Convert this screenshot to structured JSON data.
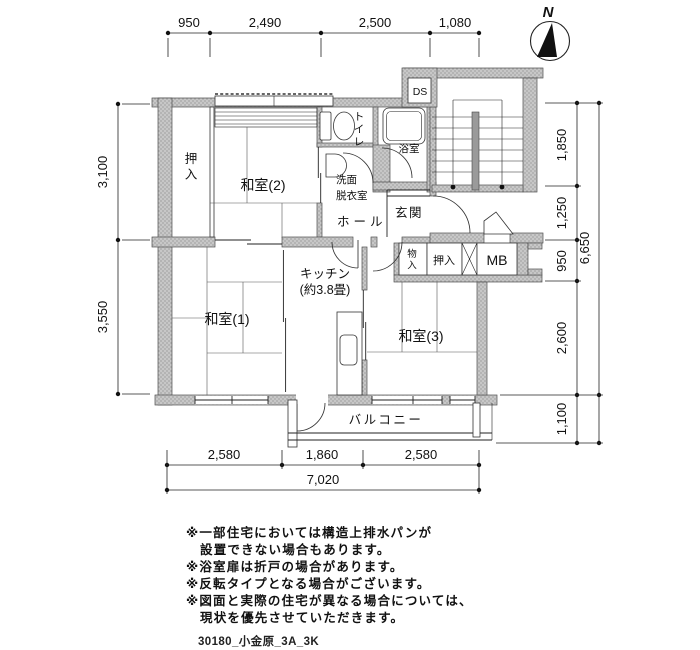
{
  "compass": {
    "north": "N"
  },
  "dimensions": {
    "top": [
      "950",
      "2,490",
      "2,500",
      "1,080"
    ],
    "left": [
      "3,100",
      "3,550"
    ],
    "right": [
      "1,850",
      "1,250",
      "950",
      "2,600",
      "1,100"
    ],
    "right_total": "6,650",
    "bottom": [
      "2,580",
      "1,860",
      "2,580"
    ],
    "bottom_total": "7,020"
  },
  "rooms": {
    "closet_left": "押入",
    "washitsu2": "和室(2)",
    "toilet": "トイレ",
    "bath": "浴室",
    "duct": "DS",
    "washroom_line1": "洗面",
    "washroom_line2": "脱衣室",
    "hall": "ホール",
    "entrance": "玄関",
    "kitchen_line1": "キッチン",
    "kitchen_line2": "(約3.8畳)",
    "washitsu1": "和室(1)",
    "washitsu3": "和室(3)",
    "storage": "物入",
    "closet_right": "押入",
    "meter_box": "MB",
    "balcony": "バルコニー"
  },
  "notes": [
    "※一部住宅においては構造上排水パンが",
    "設置できない場合もあります。",
    "※浴室扉は折戸の場合があります。",
    "※反転タイプとなる場合がございます。",
    "※図面と実際の住宅が異なる場合については、",
    "現状を優先させていただきます。"
  ],
  "footer": {
    "file_label": "30180_小金原_3A_3K"
  }
}
